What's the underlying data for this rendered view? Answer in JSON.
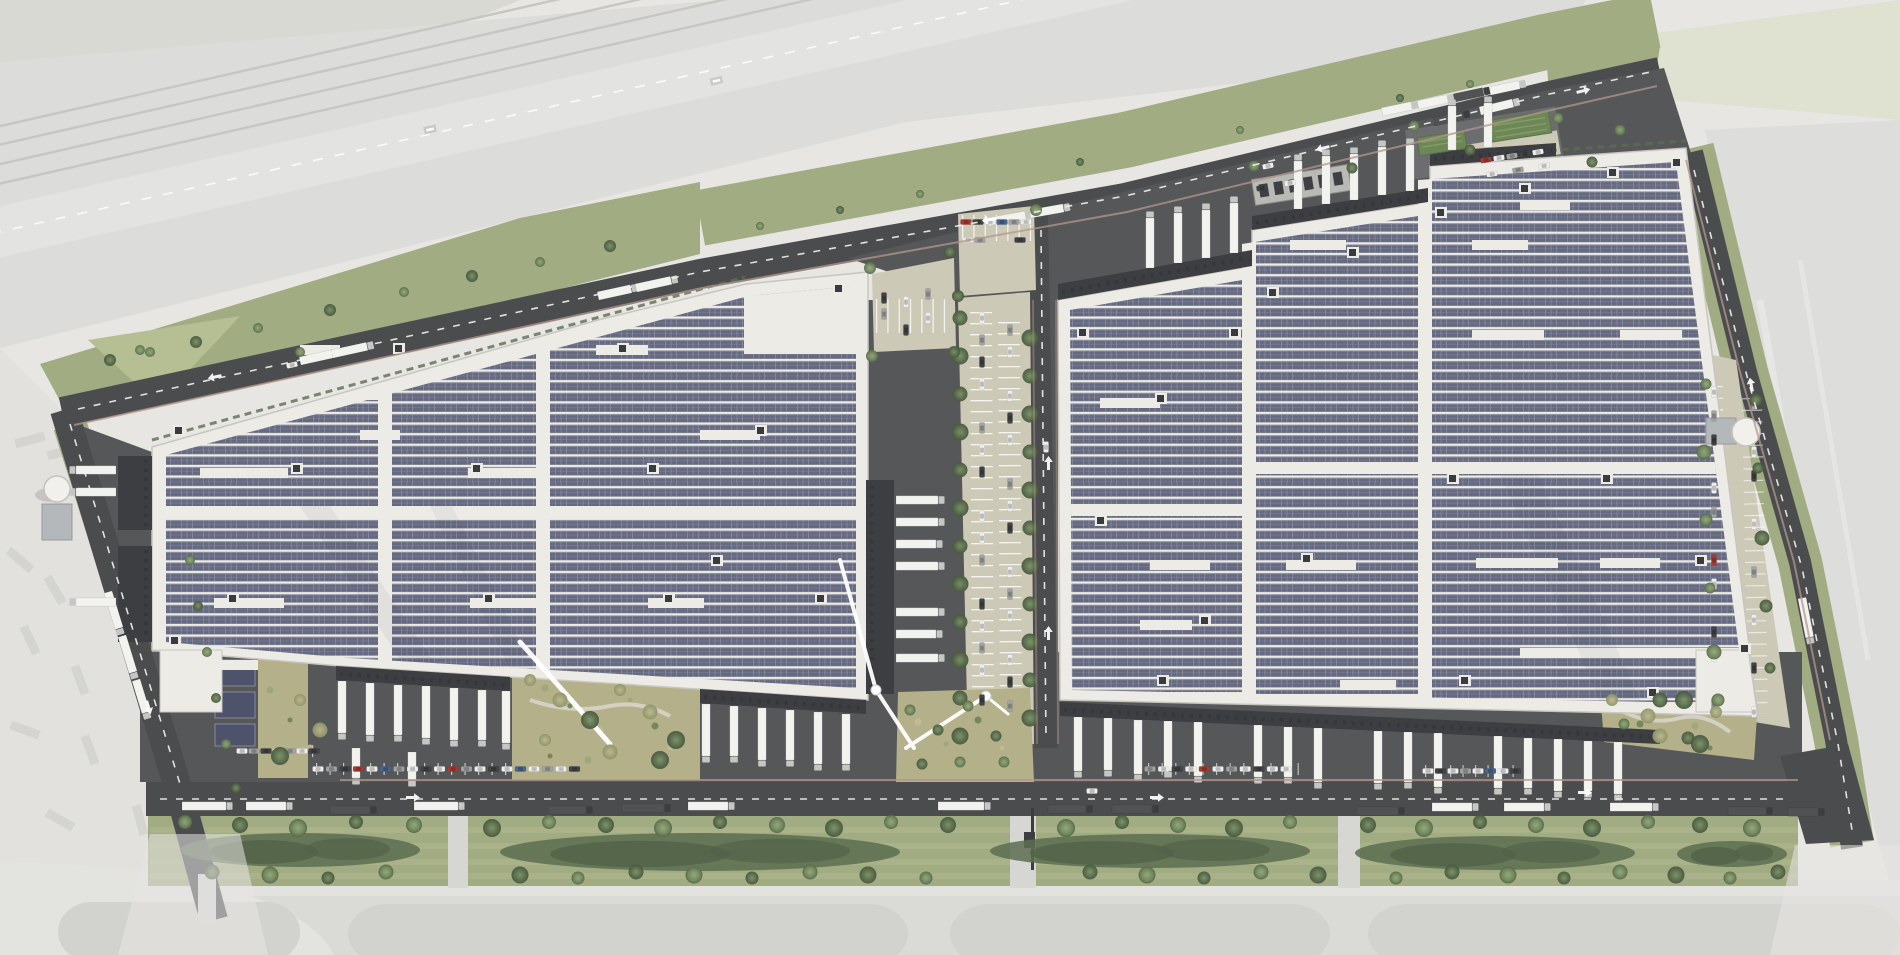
{
  "scene": {
    "type": "aerial-architectural-rendering",
    "subject": "logistics park site plan with two large solar-roofed warehouse buildings",
    "visible_text": [],
    "buildings": [
      {
        "name": "warehouse-west",
        "roof": "photovoltaic-array",
        "solar_columns": 3,
        "dock_sides": [
          "west",
          "east",
          "south"
        ]
      },
      {
        "name": "warehouse-east",
        "roof": "photovoltaic-array",
        "solar_columns": 3,
        "dock_sides": [
          "north",
          "south"
        ]
      }
    ],
    "environment": [
      "faded railway and highway corridor along north-west",
      "faded existing industrial yard to west",
      "faded field to east and pale pavement to south",
      "dark perimeter roads with white dashed centerlines and arrows",
      "central tree-lined car park between buildings",
      "truck laybys along the southern road",
      "southern green buffer with tree rows and hedges",
      "solar carports and landscaped gardens at south-west corner",
      "two white sprinkler water tanks",
      "gatehouse strip and green-roofed shelters at north-east"
    ]
  },
  "palette": {
    "fadedBase": "#e7e6e3",
    "fadedForest": "#d8d9d3",
    "fadedBlob": "#cdcfc7",
    "corridor": "#dcdcda",
    "corridorRoad": "#e3e3e1",
    "trackLine": "#c6c6c3",
    "fadedGreen": "#dfe2d1",
    "fadedField": "#dddddb",
    "fadedYard": "#e2e1de",
    "fadedVehicle": "#cfcfcb",
    "fadedLot": "#d2d2cf",
    "fadedBand": "#e3e3e0",
    "grass": "#a2ac82",
    "grassLight": "#b6bf94",
    "olive": "#b3b08a",
    "oliveDark": "#8a8f63",
    "hedge": "#5c6d51",
    "hedgeDark": "#526248",
    "asphalt": "#4b4c4e",
    "apron": "#565759",
    "roadDash": "#f2f2f0",
    "accentCurb": "#b2978c",
    "roofWhite": "#edebe6",
    "roofEdge": "#c8c6c1",
    "panel": "#666a80",
    "panelDark": "#4e526b",
    "panelLine": "#9599ac",
    "panelHi": "#aeb2c2",
    "canopy": "#3d3e42",
    "canopyLine": "#2e2f32",
    "truckWhite": "#f2f2ef",
    "truckDark": "#515254",
    "truckGray": "#9b9c9a",
    "carWhite": "#eeefed",
    "carGray": "#a2a4a4",
    "carDark": "#414346",
    "carRed": "#a83c34",
    "carBlue": "#49688f",
    "beige": "#cdc9b7",
    "gatehouse": "#b9bab5",
    "greenRoof": "#6d8756",
    "tank": "#f1f0ec",
    "tankBox": "#b5b8ba"
  }
}
